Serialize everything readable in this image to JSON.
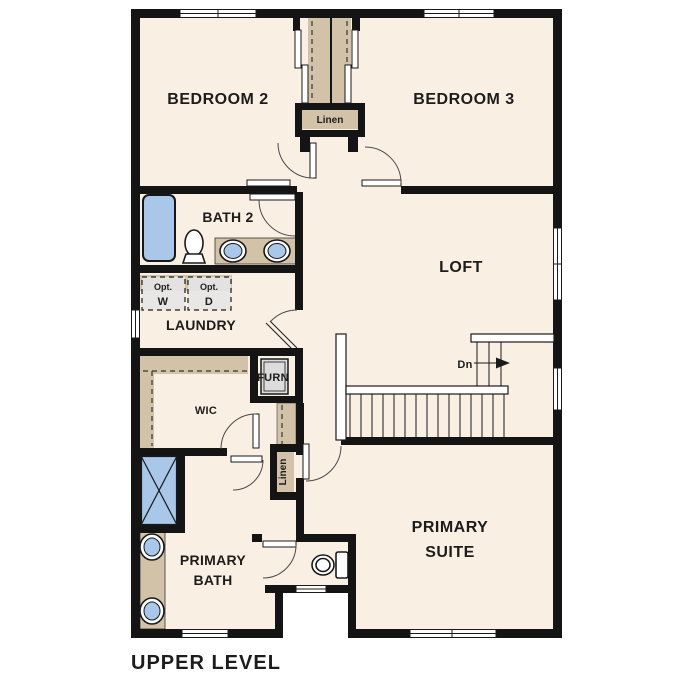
{
  "title": "UPPER LEVEL",
  "colors": {
    "wall": "#141414",
    "floor": "#f9efe2",
    "shelf_tan": "#d2c3a8",
    "fixture_blue": "#a9c8e9",
    "appliance_gray": "#e3e3e3"
  },
  "rooms": {
    "bedroom2": "BEDROOM 2",
    "bedroom3": "BEDROOM 3",
    "loft": "LOFT",
    "bath2": "BATH 2",
    "laundry": "LAUNDRY",
    "wic": "WIC",
    "furnace": "FURN",
    "linen_upper": "Linen",
    "linen_lower": "Linen",
    "primary_bath_line1": "PRIMARY",
    "primary_bath_line2": "BATH",
    "primary_suite_line1": "PRIMARY",
    "primary_suite_line2": "SUITE"
  },
  "laundry_options": {
    "washer_prefix": "Opt.",
    "washer_letter": "W",
    "dryer_prefix": "Opt.",
    "dryer_letter": "D"
  },
  "stairs": {
    "direction_label": "Dn"
  }
}
